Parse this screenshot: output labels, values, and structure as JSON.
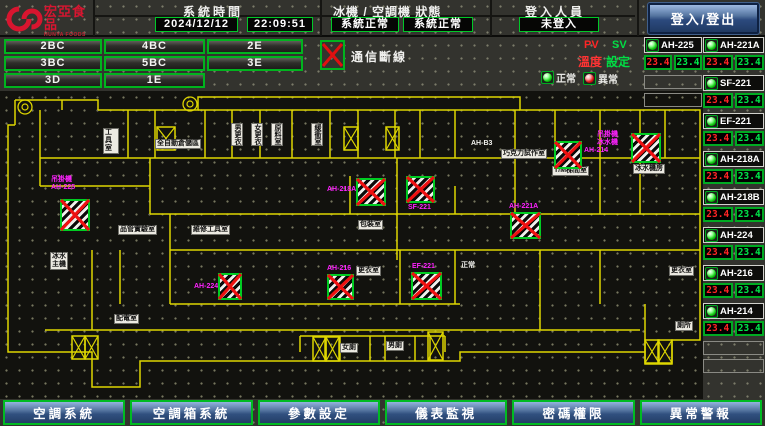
{
  "logo": {
    "brand": "宏亞食品",
    "brand_en": "HUNYA FOODS"
  },
  "header": {
    "system_time_label": "系統時間",
    "date": "2024/12/12",
    "time": "22:09:51",
    "status_label": "冰機 / 空調機 狀態",
    "chiller_status": "系統正常",
    "ac_status": "系統正常",
    "login_label": "登入人員",
    "login_status": "未登入",
    "login_button": "登入/登出"
  },
  "zone_buttons": [
    "2BC",
    "4BC",
    "2E",
    "3BC",
    "5BC",
    "3E",
    "3D",
    "1E"
  ],
  "legend": {
    "comm_fail": "通信斷線",
    "pv": "PV",
    "sv": "SV",
    "temp": "溫度",
    "set": "設定",
    "normal": "正常",
    "abnormal": "異常"
  },
  "panel": {
    "left_units": [
      {
        "name": "AH-225",
        "pv": "23.4",
        "sv": "23.4"
      }
    ],
    "left_empty_slots": 2,
    "right_units": [
      {
        "name": "AH-221A",
        "pv": "23.4",
        "sv": "23.4"
      },
      {
        "name": "SF-221",
        "pv": "23.4",
        "sv": "23.4"
      },
      {
        "name": "EF-221",
        "pv": "23.4",
        "sv": "23.4"
      },
      {
        "name": "AH-218A",
        "pv": "23.4",
        "sv": "23.4"
      },
      {
        "name": "AH-218B",
        "pv": "23.4",
        "sv": "23.4"
      },
      {
        "name": "AH-224",
        "pv": "23.4",
        "sv": "23.4"
      },
      {
        "name": "AH-216",
        "pv": "23.4",
        "sv": "23.4"
      },
      {
        "name": "AH-214",
        "pv": "23.4",
        "sv": "23.4"
      }
    ],
    "right_empty_slots": 2
  },
  "map": {
    "devices": [
      {
        "label": "吊掛機\nAH-225",
        "lx": 51,
        "ly": 176,
        "x": 60,
        "y": 199,
        "w": 30,
        "h": 32,
        "status": "comm-fail"
      },
      {
        "label": "AH-218A",
        "lx": 327,
        "ly": 186,
        "x": 356,
        "y": 178,
        "w": 30,
        "h": 28,
        "status": "comm-fail"
      },
      {
        "label": "SF-221",
        "lx": 408,
        "ly": 204,
        "x": 406,
        "y": 176,
        "w": 29,
        "h": 27,
        "status": "comm-fail"
      },
      {
        "label": "AH-214",
        "lx": 584,
        "ly": 147,
        "x": 554,
        "y": 141,
        "w": 28,
        "h": 28,
        "status": "comm-fail"
      },
      {
        "label": "吊掛機\n冰水機",
        "lx": 597,
        "ly": 131,
        "x": 631,
        "y": 133,
        "w": 30,
        "h": 30,
        "status": "comm-fail"
      },
      {
        "label": "AH-221A",
        "lx": 509,
        "ly": 203,
        "x": 510,
        "y": 212,
        "w": 31,
        "h": 27,
        "status": "comm-fail"
      },
      {
        "label": "AH-224",
        "lx": 194,
        "ly": 283,
        "x": 218,
        "y": 273,
        "w": 24,
        "h": 27,
        "status": "comm-fail"
      },
      {
        "label": "AH-216",
        "lx": 327,
        "ly": 265,
        "x": 327,
        "y": 274,
        "w": 27,
        "h": 26,
        "status": "comm-fail"
      },
      {
        "label": "EF-221",
        "lx": 412,
        "ly": 263,
        "x": 411,
        "y": 272,
        "w": 31,
        "h": 28,
        "status": "comm-fail"
      }
    ],
    "rooms": [
      {
        "label": "工具室",
        "x": 103,
        "y": 128,
        "style": "chip",
        "w": 16
      },
      {
        "label": "全自動倉儲區",
        "x": 155,
        "y": 139,
        "style": "chip"
      },
      {
        "label": "男更衣",
        "x": 231,
        "y": 123,
        "style": "chip",
        "vertical": true
      },
      {
        "label": "女更衣",
        "x": 251,
        "y": 123,
        "style": "chip",
        "vertical": true
      },
      {
        "label": "原料室",
        "x": 271,
        "y": 123,
        "style": "chip",
        "vertical": true
      },
      {
        "label": "緩衝室",
        "x": 311,
        "y": 123,
        "style": "chip",
        "vertical": true
      },
      {
        "label": "AH-B3",
        "x": 471,
        "y": 140,
        "style": "text"
      },
      {
        "label": "巧克力試作室",
        "x": 501,
        "y": 149,
        "style": "chip"
      },
      {
        "label": "T/M梯間室",
        "x": 552,
        "y": 166,
        "style": "chip"
      },
      {
        "label": "冰水機房",
        "x": 633,
        "y": 164,
        "style": "chip"
      },
      {
        "label": "包裝室",
        "x": 358,
        "y": 220,
        "style": "chip"
      },
      {
        "label": "更衣室",
        "x": 356,
        "y": 266,
        "style": "chip"
      },
      {
        "label": "正常",
        "x": 461,
        "y": 262,
        "style": "text"
      },
      {
        "label": "品管實驗室",
        "x": 118,
        "y": 225,
        "style": "chip"
      },
      {
        "label": "維修工具室",
        "x": 191,
        "y": 225,
        "style": "chip"
      },
      {
        "label": "冰水\n主機",
        "x": 50,
        "y": 252,
        "style": "chip"
      },
      {
        "label": "配電室",
        "x": 114,
        "y": 314,
        "style": "chip"
      },
      {
        "label": "女廁",
        "x": 340,
        "y": 343,
        "style": "chip"
      },
      {
        "label": "男廁",
        "x": 386,
        "y": 341,
        "style": "chip"
      },
      {
        "label": "更衣室",
        "x": 669,
        "y": 266,
        "style": "chip"
      },
      {
        "label": "廁所",
        "x": 675,
        "y": 321,
        "style": "chip"
      }
    ]
  },
  "nav_buttons": [
    "空調系統",
    "空調箱系統",
    "參數設定",
    "儀表監視",
    "密碼權限",
    "異常警報"
  ],
  "colors": {
    "accent_green": "#00bb22",
    "alarm_red": "#ee1111",
    "device_magenta": "#ff22ff",
    "wall_yellow": "#ded600",
    "nav_blue": "#31507f"
  }
}
